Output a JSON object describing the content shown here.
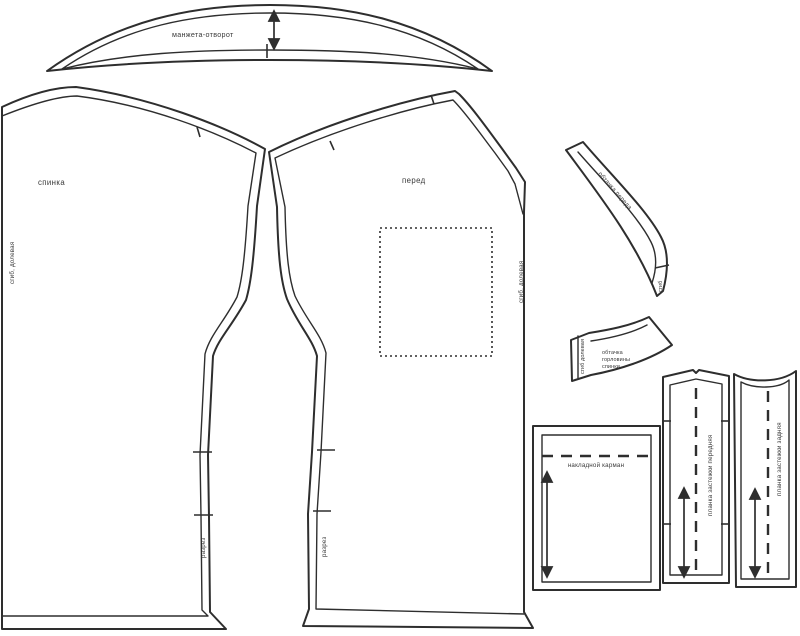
{
  "document": {
    "kind": "sewing-pattern-sheet",
    "language": "ru"
  },
  "colors": {
    "line": "#2e2e2e",
    "text": "#3a3a3a",
    "background": "#ffffff"
  },
  "pieces": {
    "cuff_lapel": {
      "name": "манжета-отворот"
    },
    "back": {
      "name": "спинка",
      "grain_label": "сгиб, долевая",
      "slit_label": "разрез"
    },
    "front": {
      "name": "перед",
      "grain_label": "сгиб, долевая",
      "slit_label": "разрез"
    },
    "front_facing": {
      "name": "обтачка переда",
      "fold_label": "сгиб"
    },
    "back_neck_facing": {
      "name_lines": [
        "обтачка",
        "горловины",
        "спинки"
      ],
      "grain_label": "сгиб долевая"
    },
    "patch_pocket": {
      "name": "накладной карман"
    },
    "front_placket": {
      "name": "планка застежки передняя"
    },
    "back_placket": {
      "name": "планка застежки задняя"
    }
  }
}
